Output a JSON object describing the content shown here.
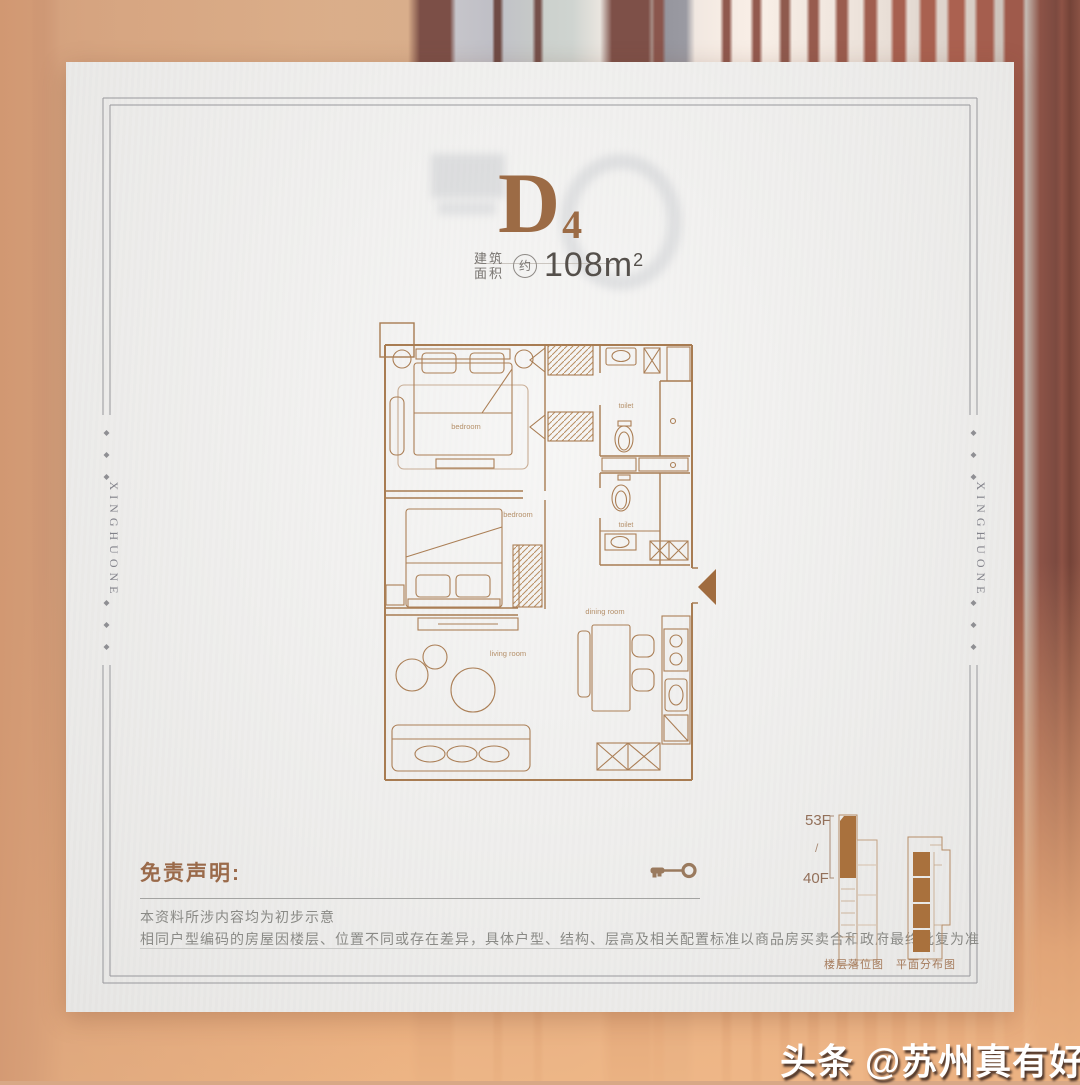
{
  "title": {
    "unit": "D",
    "unit_sub": "4",
    "area_label_line1": "建筑",
    "area_label_line2": "面积",
    "approx": "约",
    "area_value": "108m",
    "area_sup": "2"
  },
  "side_text": {
    "left": "XINGHUONE",
    "right": "XINGHUONE"
  },
  "floor_plan": {
    "labels": {
      "bedroom1": "bedroom",
      "bedroom2": "bedroom",
      "toilet1": "toilet",
      "toilet2": "toilet",
      "dining": "dining room",
      "living": "living room"
    }
  },
  "disclaimer": {
    "heading": "免责声明:",
    "line1": "本资料所涉内容均为初步示意",
    "line2": "相同户型编码的房屋因楼层、位置不同或存在差异，具体户型、结构、层高及相关配置标准以商品房买卖合和政府最终批复为准"
  },
  "diagrams": {
    "floor_top": "53F",
    "floor_sep": "/",
    "floor_bottom": "40F",
    "left_caption": "楼层落位图",
    "right_caption": "平面分布图"
  },
  "watermark": {
    "text": "头条 @苏州真有好房"
  },
  "colors": {
    "accent_brown": "#9c6b45",
    "plan_line": "#a87c52",
    "plan_fill": "#a9713d",
    "paper": "#edecea",
    "frame_gray": "#98989c",
    "disclaimer_text": "#8a8a86",
    "background_orange": "#dca57e"
  }
}
